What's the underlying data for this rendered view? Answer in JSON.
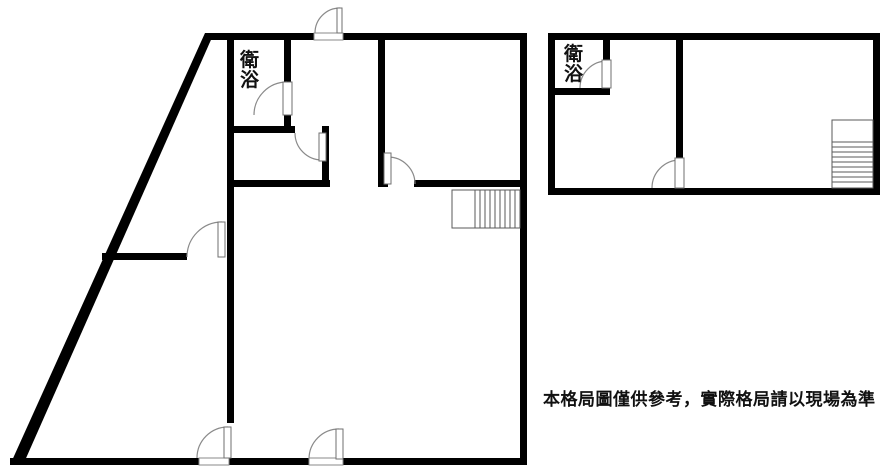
{
  "canvas": {
    "width": 889,
    "height": 473,
    "background": "#ffffff",
    "wall_color": "#000000",
    "door_color": "#8a8a8a",
    "leaf_stroke": "#6f6f6f",
    "stair_color": "#5a5a5a"
  },
  "disclaimer": {
    "text": "本格局圖僅供參考，實際格局請以現場為準",
    "x": 543,
    "y": 385,
    "font_size": 17,
    "width": 345
  },
  "floorplans": [
    {
      "name": "left-unit-plan",
      "bathroom_label": {
        "text": "衛浴",
        "x": 240,
        "y": 51,
        "font_size": 19,
        "width": 24
      },
      "walls": [
        [
          205,
          33,
          109,
          7
        ],
        [
          343,
          33,
          184,
          7
        ],
        [
          520,
          33,
          7,
          432
        ],
        [
          10,
          458,
          190,
          7
        ],
        [
          228,
          458,
          82,
          7
        ],
        [
          342,
          458,
          185,
          7
        ],
        [
          227,
          40,
          7,
          383
        ],
        [
          284,
          40,
          7,
          42
        ],
        [
          284,
          115,
          7,
          12
        ],
        [
          227,
          126,
          68,
          7
        ],
        [
          322,
          126,
          7,
          61
        ],
        [
          227,
          180,
          103,
          7
        ],
        [
          378,
          40,
          7,
          147
        ],
        [
          378,
          180,
          10,
          7
        ],
        [
          414,
          180,
          113,
          7
        ],
        [
          102,
          253,
          85,
          7
        ]
      ],
      "polygons": [
        {
          "name": "slanted-exterior-wall",
          "points": "205,33 214,33 23,465 10,465"
        }
      ],
      "doors": [
        {
          "name": "entry-door-top",
          "sill": [
            314,
            33,
            29,
            7
          ],
          "leaf": [
            337,
            8,
            5,
            25
          ],
          "arc": "M 315 33 A 25 25 0 0 1 340 8"
        },
        {
          "name": "bathroom-door",
          "leaf": [
            283,
            82,
            9,
            33
          ],
          "arc": "M 254 115 A 33 33 0 0 1 287 82"
        },
        {
          "name": "closet-door",
          "leaf": [
            319,
            133,
            7,
            28
          ],
          "arc": "M 295 133 A 27 27 0 0 0 322 160"
        },
        {
          "name": "upper-right-room-door",
          "leaf": [
            384,
            153,
            7,
            31
          ],
          "arc": "M 388 157 A 27 27 0 0 1 415 184"
        },
        {
          "name": "wedge-room-door",
          "leaf": [
            218,
            222,
            7,
            35
          ],
          "arc": "M 187 257 A 35 35 0 0 1 222 222"
        },
        {
          "name": "bottom-door-left",
          "sill": [
            199,
            458,
            30,
            7
          ],
          "leaf": [
            224,
            427,
            7,
            31
          ],
          "arc": "M 197 458 A 31 31 0 0 1 228 427"
        },
        {
          "name": "bottom-door-right",
          "sill": [
            309,
            458,
            34,
            7
          ],
          "leaf": [
            336,
            429,
            7,
            30
          ],
          "arc": "M 309 459 A 30 30 0 0 1 339 429"
        }
      ],
      "stairs": {
        "rect": [
          452,
          190,
          68,
          38
        ],
        "treads": [
          [
            475,
            190,
            475,
            228
          ],
          [
            480,
            190,
            480,
            228
          ],
          [
            485,
            190,
            485,
            228
          ],
          [
            490,
            190,
            490,
            228
          ],
          [
            495,
            190,
            495,
            228
          ],
          [
            500,
            190,
            500,
            228
          ],
          [
            505,
            190,
            505,
            228
          ],
          [
            510,
            190,
            510,
            228
          ],
          [
            515,
            190,
            515,
            228
          ]
        ]
      }
    },
    {
      "name": "right-unit-plan",
      "bathroom_label": {
        "text": "衛浴",
        "x": 564,
        "y": 45,
        "font_size": 19,
        "width": 24
      },
      "walls": [
        [
          548,
          33,
          332,
          7
        ],
        [
          548,
          40,
          7,
          148
        ],
        [
          873,
          40,
          7,
          155
        ],
        [
          548,
          188,
          332,
          7
        ],
        [
          603,
          40,
          7,
          20
        ],
        [
          555,
          88,
          55,
          7
        ],
        [
          676,
          40,
          7,
          118
        ]
      ],
      "polygons": [],
      "doors": [
        {
          "name": "bathroom-door",
          "leaf": [
            602,
            60,
            9,
            28
          ],
          "arc": "M 580 88 A 27 27 0 0 1 607 61"
        },
        {
          "name": "room-door",
          "leaf": [
            675,
            158,
            9,
            30
          ],
          "arc": "M 652 188 A 28 28 0 0 1 680 160"
        }
      ],
      "stairs": {
        "rect": [
          832,
          120,
          41,
          68
        ],
        "treads": [
          [
            832,
            142,
            873,
            142
          ],
          [
            832,
            147,
            873,
            147
          ],
          [
            832,
            152,
            873,
            152
          ],
          [
            832,
            157,
            873,
            157
          ],
          [
            832,
            162,
            873,
            162
          ],
          [
            832,
            167,
            873,
            167
          ],
          [
            832,
            172,
            873,
            172
          ],
          [
            832,
            177,
            873,
            177
          ],
          [
            832,
            182,
            873,
            182
          ]
        ]
      }
    }
  ]
}
